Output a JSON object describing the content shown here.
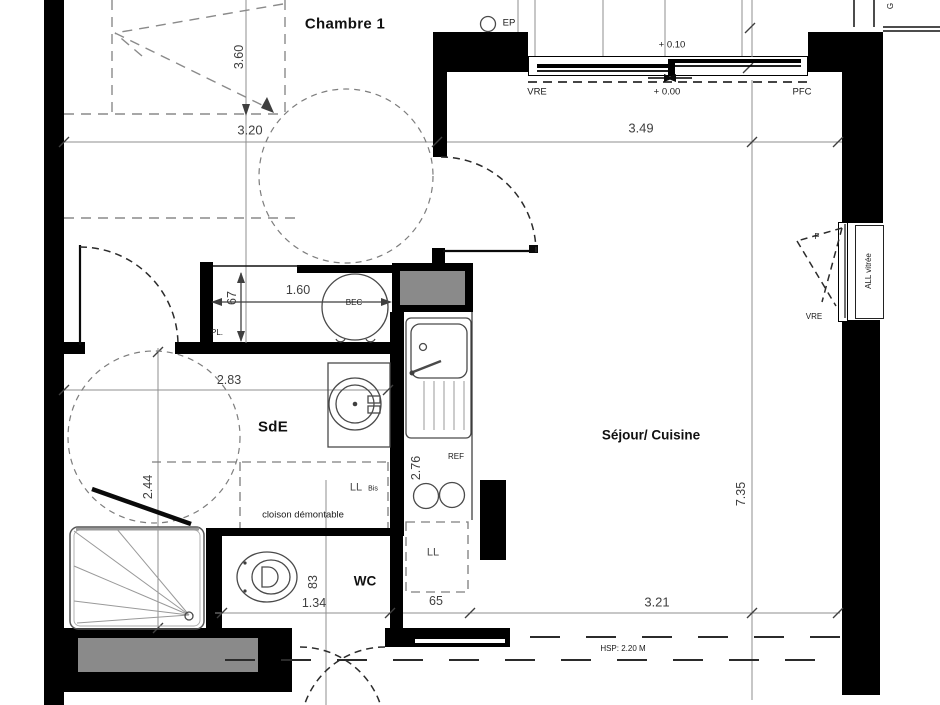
{
  "plan": {
    "rooms": {
      "chambre": "Chambre 1",
      "sde": "SdE",
      "wc": "WC",
      "sejour": "Séjour/ Cuisine"
    },
    "fixtures": {
      "bec": "BEC",
      "pl": "PL.",
      "ref": "REF",
      "ll": "LL",
      "ll_bis": "LL",
      "ll_bis_suffix": "Bis",
      "ep": "EP"
    },
    "openings": {
      "vre_top": "VRE",
      "pfc": "PFC",
      "f": "F",
      "vre_right": "VRE",
      "all_vitree": "ALL vitrée",
      "g": "G"
    },
    "levels": {
      "upper": "+ 0.10",
      "lower": "+ 0.00"
    },
    "notes": {
      "cloison": "cloison démontable",
      "hsp": "HSP: 2.20 M"
    },
    "dims": {
      "d360": "3.60",
      "d320": "3.20",
      "d349": "3.49",
      "d160": "1.60",
      "d67": "67",
      "d283": "2.83",
      "d244": "2.44",
      "d276": "2.76",
      "d735": "7.35",
      "d83": "83",
      "d134": "1.34",
      "d65": "65",
      "d321": "3.21"
    },
    "colors": {
      "wall": "#000000",
      "shaft": "#8a8a8a",
      "dim-line": "#8f8f8f",
      "dim-text": "#3f3f3f",
      "label": "#111111"
    }
  }
}
